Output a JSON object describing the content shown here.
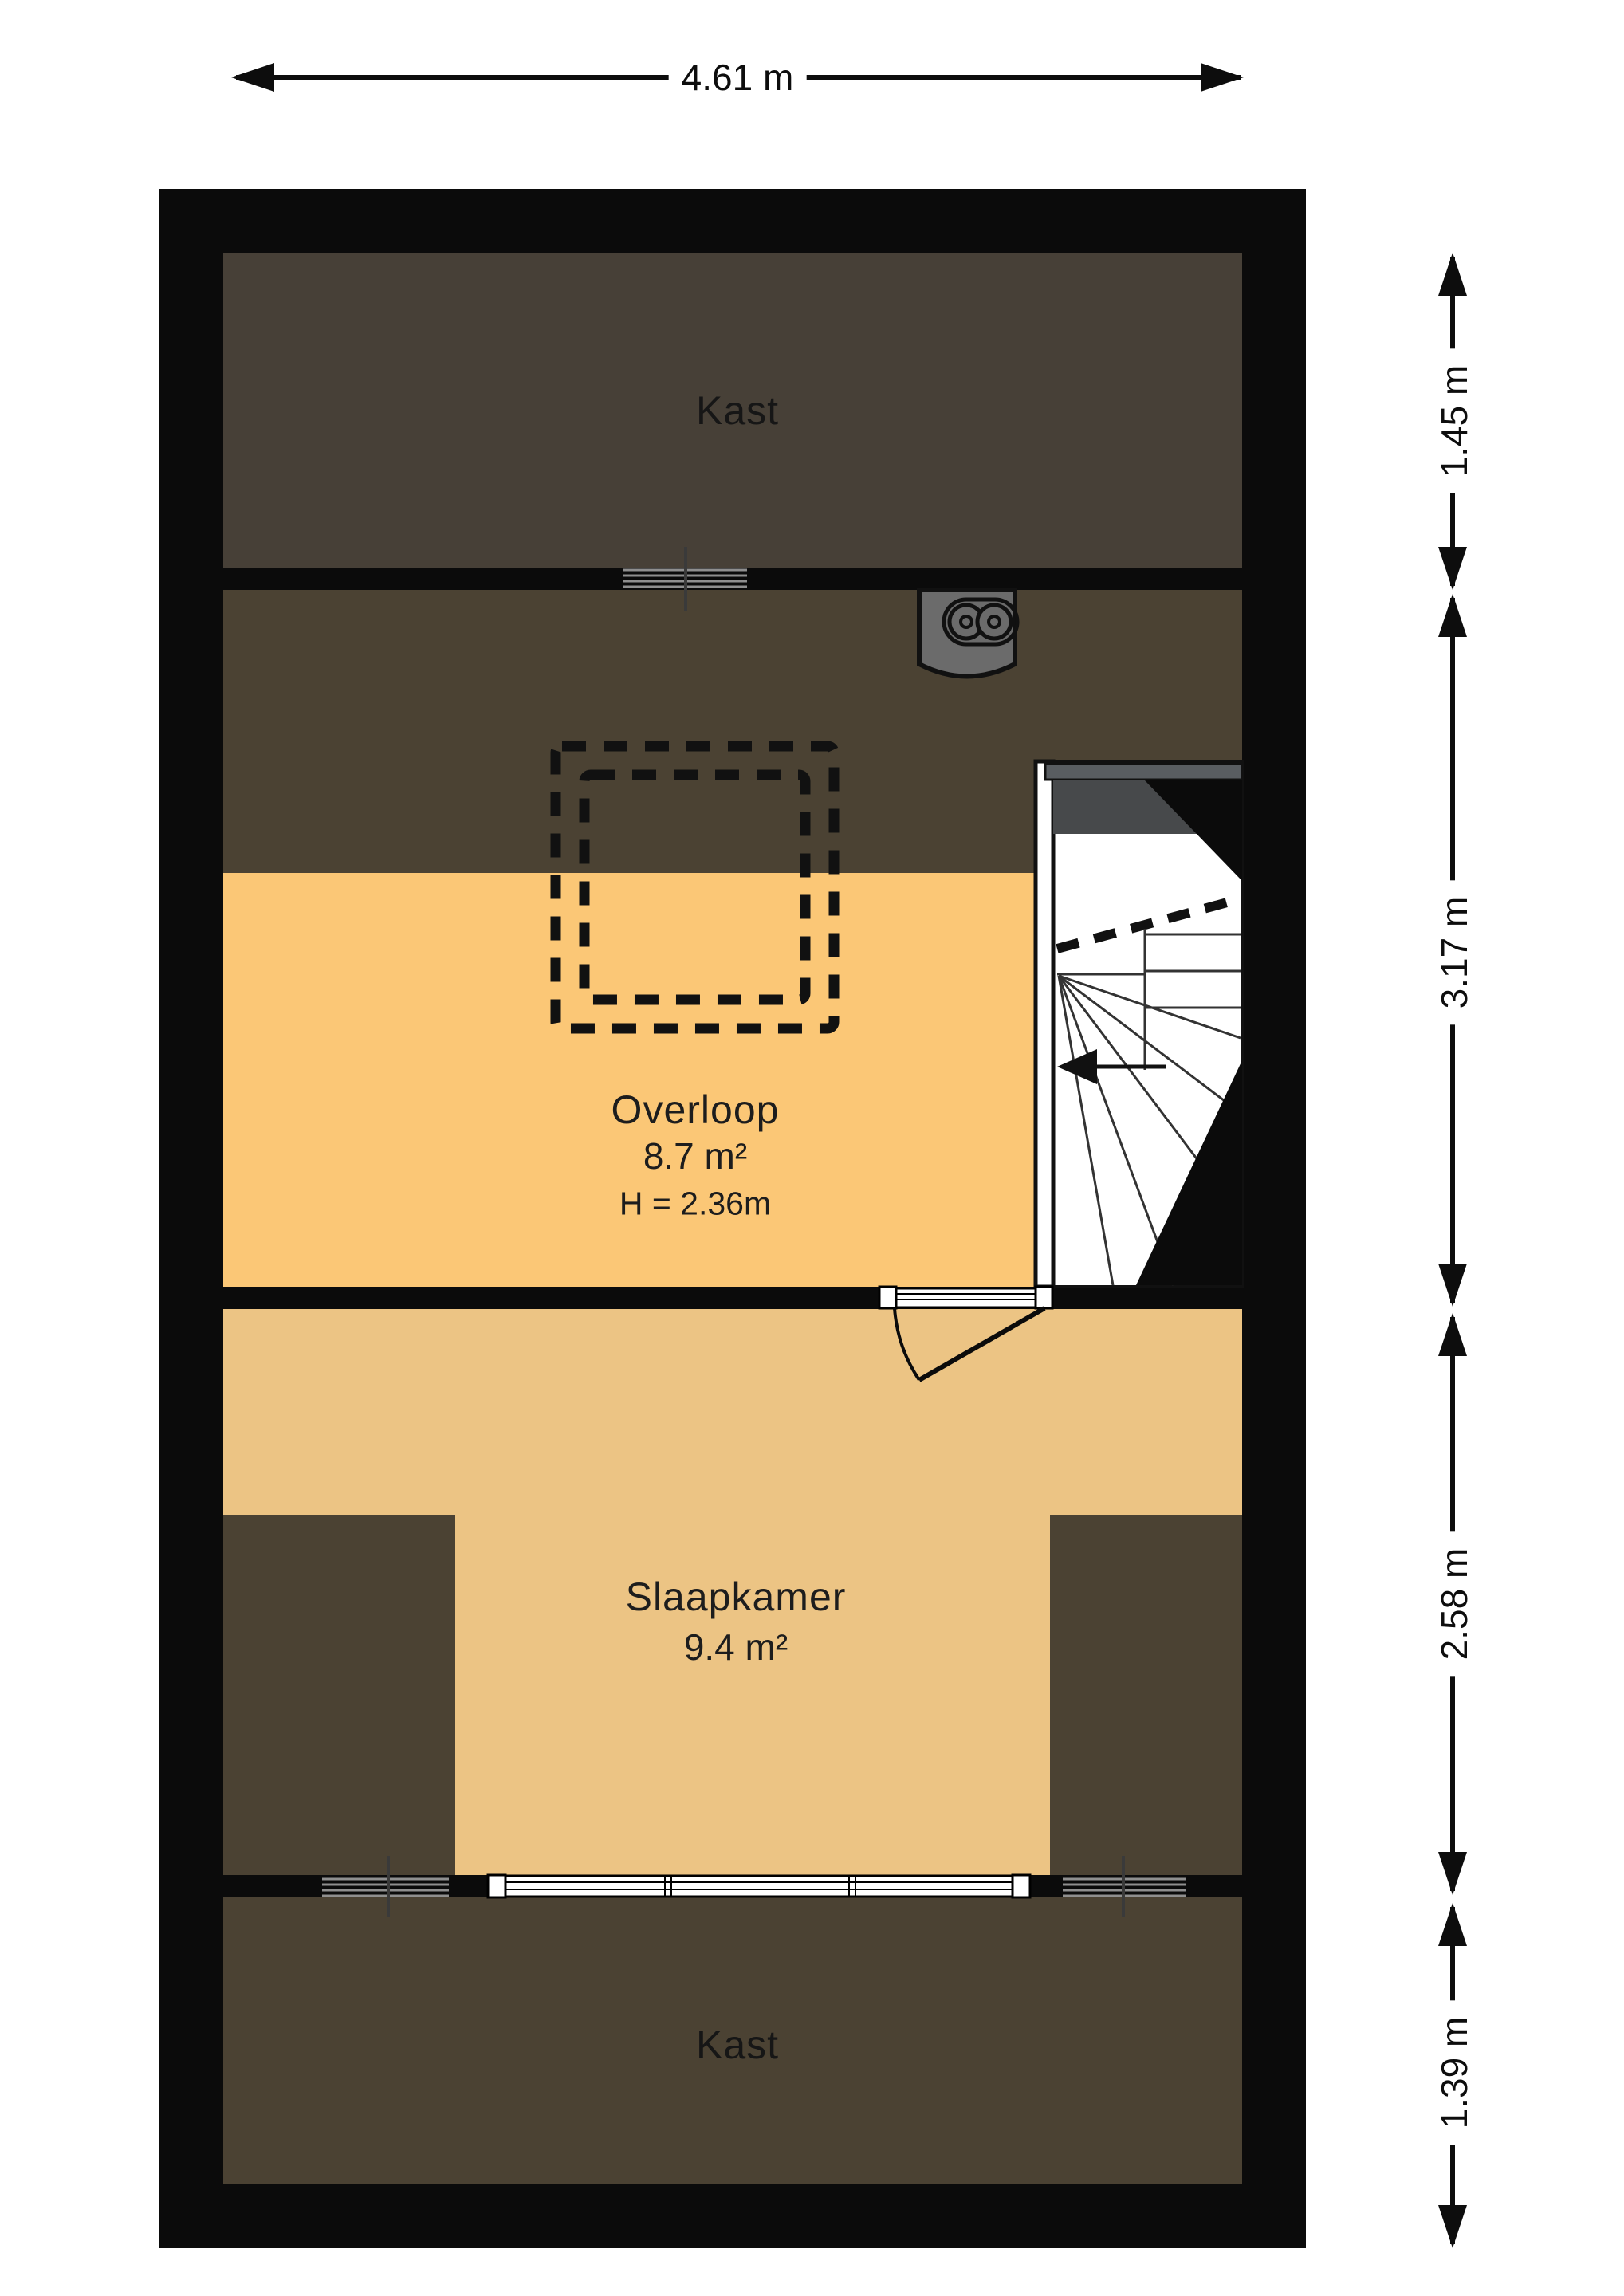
{
  "plan": {
    "top_dimension": {
      "label": "4.61 m"
    },
    "right_dimensions": [
      {
        "label": "1.45 m"
      },
      {
        "label": "3.17 m"
      },
      {
        "label": "2.58 m"
      },
      {
        "label": "1.39 m"
      }
    ],
    "rooms": {
      "kast_top": {
        "label": "Kast"
      },
      "overloop": {
        "label": "Overloop",
        "area": "8.7 m²",
        "ceiling_height": "H = 2.36m"
      },
      "slaapkamer": {
        "label": "Slaapkamer",
        "area": "9.4 m²"
      },
      "kast_bottom": {
        "label": "Kast"
      }
    },
    "colors": {
      "wall": "#0b0b0b",
      "kast_fill": "#474037",
      "under_roof_fill": "#4b4233",
      "overloop_fill": "#fbc776",
      "slaapkamer_fill": "#ecc484",
      "stair_header_gray": "#595d61",
      "stair_dark_gray": "#47494b",
      "window_line_gray": "#8f8f8f",
      "background": "#ffffff"
    }
  }
}
